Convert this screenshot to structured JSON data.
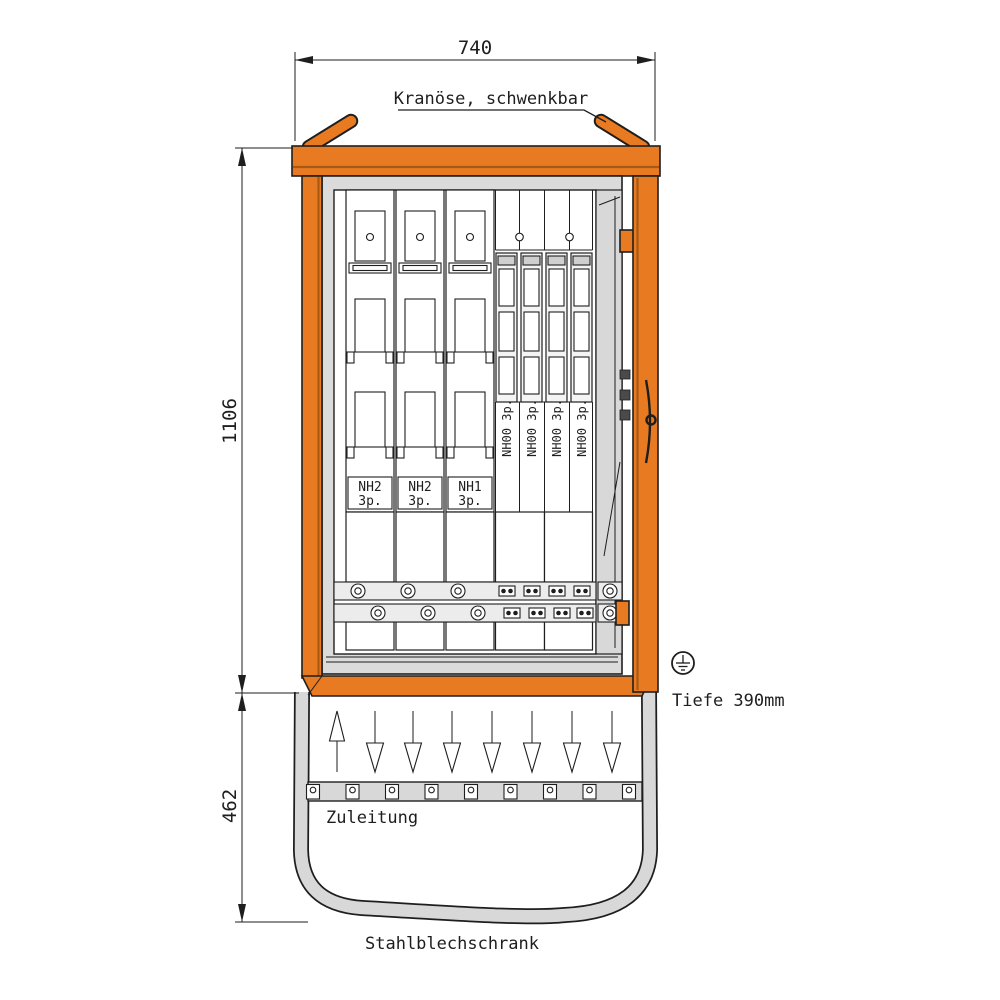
{
  "meta": {
    "type_label": "Stahlblechschrank"
  },
  "dimensions": {
    "width_mm": "740",
    "height_mm": "1106",
    "base_height_mm": "462",
    "depth_label": "Tiefe 390mm"
  },
  "annotations": {
    "crane_eye": "Kranöse, schwenkbar",
    "supply": "Zuleitung"
  },
  "modules": {
    "wide": [
      {
        "type": "NH2",
        "poles": "3p."
      },
      {
        "type": "NH2",
        "poles": "3p."
      },
      {
        "type": "NH1",
        "poles": "3p."
      }
    ],
    "narrow": [
      {
        "label": "NH00 3p."
      },
      {
        "label": "NH00 3p."
      },
      {
        "label": "NH00 3p."
      },
      {
        "label": "NH00 3p."
      }
    ]
  },
  "icons": {
    "earth": "protective-earth-symbol",
    "crane_eye_left": "crane-lifting-eye",
    "crane_eye_right": "crane-lifting-eye",
    "supply_arrow": "arrow-up",
    "outgoing_arrow": "arrow-down"
  },
  "colors": {
    "orange": "#E87A22",
    "orange_dark": "#A85A14",
    "gray_panel": "#DBDBDB",
    "gray_base": "#D8D8D8",
    "line": "#1E1E1E"
  }
}
